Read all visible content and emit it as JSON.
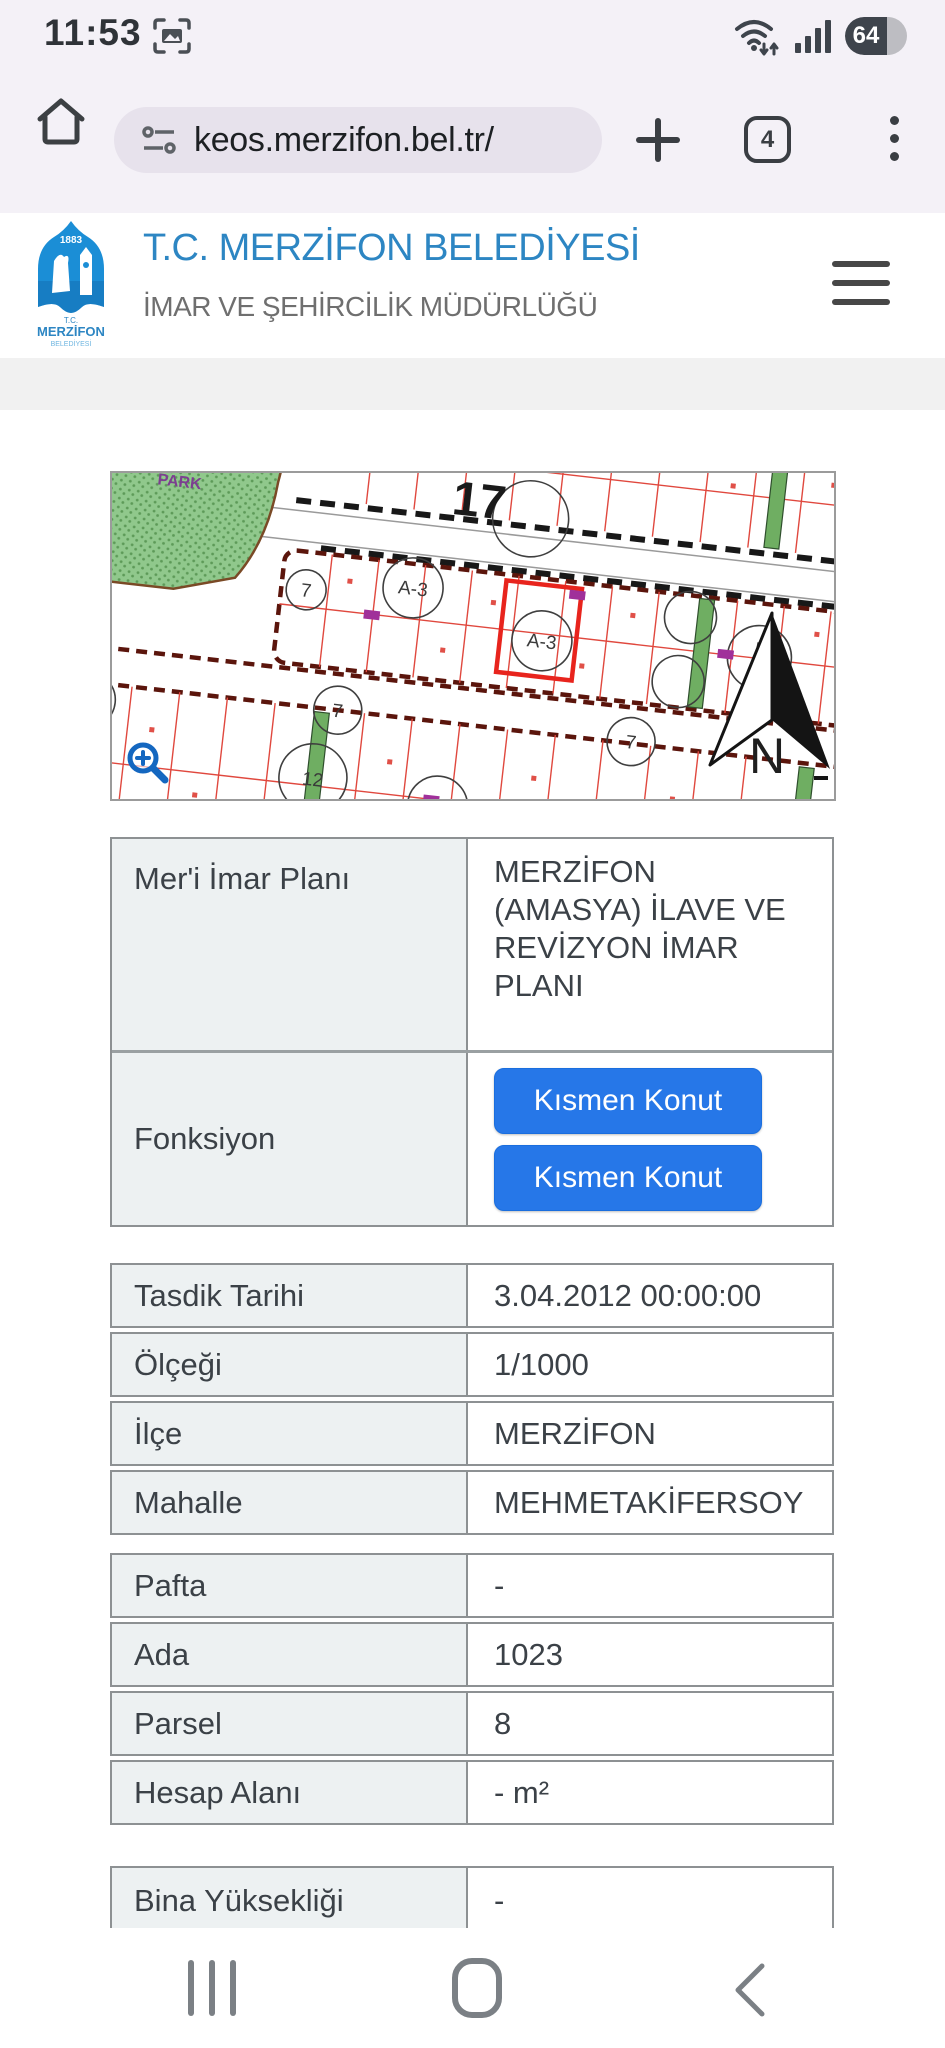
{
  "status_bar": {
    "time": "11:53",
    "battery_percent": "64"
  },
  "browser_bar": {
    "url": "keos.merzifon.bel.tr/",
    "tab_count": "4"
  },
  "site_header": {
    "title": "T.C. MERZİFON BELEDİYESİ",
    "subtitle": "İMAR VE ŞEHİRCİLİK MÜDÜRLÜĞÜ",
    "logo": {
      "year": "1883",
      "tc": "T.C.",
      "name": "MERZİFON",
      "sub": "BELEDİYESİ"
    }
  },
  "map": {
    "big_label": "17",
    "north_label": "N",
    "park_label": "PARK",
    "circle_labels": {
      "c1": "A-3",
      "c2": "7",
      "c3": "A-3",
      "c4": "5",
      "c5": "7",
      "c6": "7",
      "c7": "12",
      "c8": "A-3"
    }
  },
  "plan_table": {
    "rows": [
      {
        "label": "Mer'i İmar Planı",
        "value": "MERZİFON (AMASYA) İLAVE VE REVİZYON İMAR PLANI"
      },
      {
        "label": "Fonksiyon",
        "buttons": [
          "Kısmen Konut",
          "Kısmen Konut"
        ]
      }
    ]
  },
  "detail_table": {
    "rows": [
      {
        "label": "Tasdik Tarihi",
        "value": "3.04.2012 00:00:00"
      },
      {
        "label": "Ölçeği",
        "value": "1/1000"
      },
      {
        "label": "İlçe",
        "value": "MERZİFON"
      },
      {
        "label": "Mahalle",
        "value": "MEHMETAKİFERSOY"
      }
    ]
  },
  "parcel_table": {
    "rows": [
      {
        "label": "Pafta",
        "value": "-"
      },
      {
        "label": "Ada",
        "value": "1023"
      },
      {
        "label": "Parsel",
        "value": "8"
      },
      {
        "label": "Hesap Alanı",
        "value": "- m²"
      }
    ]
  },
  "building_table": {
    "rows": [
      {
        "label": "Bina Yüksekliği",
        "value": "-"
      }
    ]
  },
  "colors": {
    "accent_blue": "#2d86c3",
    "button_blue": "#2677e8",
    "selected_parcel_red": "#e8241d",
    "park_green": "#8fc98b",
    "table_label_bg": "#edf1f2",
    "table_border": "#8d9193",
    "chrome_bg": "#f4f1f7"
  }
}
